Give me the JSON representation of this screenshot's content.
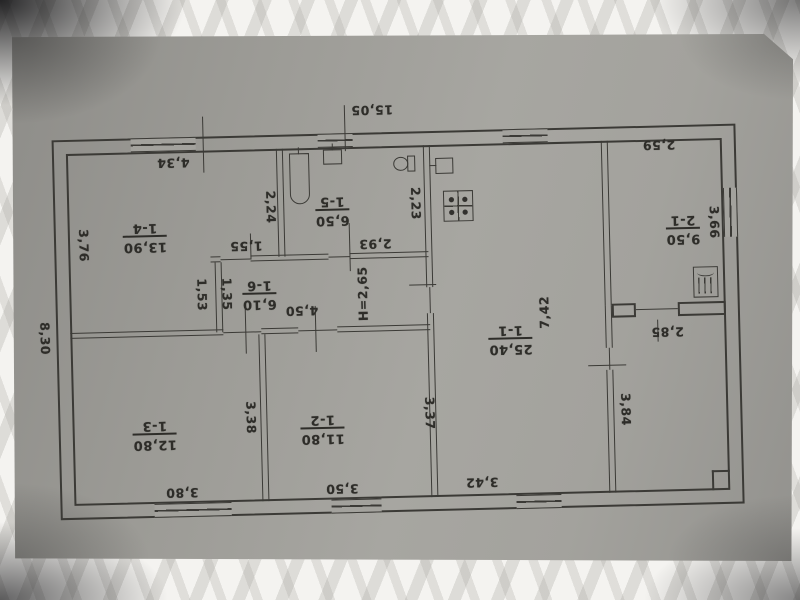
{
  "document": {
    "kind": "technical floor plan photo (rotated 180°)",
    "height_note": "H=2,65"
  },
  "rooms": {
    "r11": {
      "number": "1-1",
      "area": "25,40"
    },
    "r12": {
      "number": "1-2",
      "area": "11,80"
    },
    "r13": {
      "number": "1-3",
      "area": "12,80"
    },
    "r14": {
      "number": "1-4",
      "area": "13,90"
    },
    "r15": {
      "number": "1-5",
      "area": "6,50"
    },
    "r16": {
      "number": "1-6",
      "area": "6,10"
    },
    "r21": {
      "number": "2-1",
      "area": "9,50"
    }
  },
  "dims": {
    "total_top": "15,05",
    "left_total": "8,30",
    "r14_top": "4,34",
    "r14_left": "3,76",
    "bath_left": "2,24",
    "bath_right": "2,23",
    "bath_bottom": "2,93",
    "seg": "1,55",
    "notch": "1,53",
    "corr_w": "1,35",
    "corr_len": "4,50",
    "height_note": "H=2,65",
    "r21_top": "2,59",
    "r21_right": "3,66",
    "r11_h": "7,42",
    "r11_bottom": "3,42",
    "r12_right": "3,37",
    "r12_bottom": "3,50",
    "r13_right": "3,38",
    "r13_bottom": "3,80",
    "ver_top": "2,85",
    "ver_left": "3,84"
  },
  "fixtures": [
    "bathtub",
    "bathroom-sink",
    "toilet",
    "kitchen-sink",
    "gas-stove",
    "furnace"
  ],
  "colors": {
    "paper": "#a3a29d",
    "ink": "#3b3a36",
    "cloth": "#f4f3f0"
  }
}
